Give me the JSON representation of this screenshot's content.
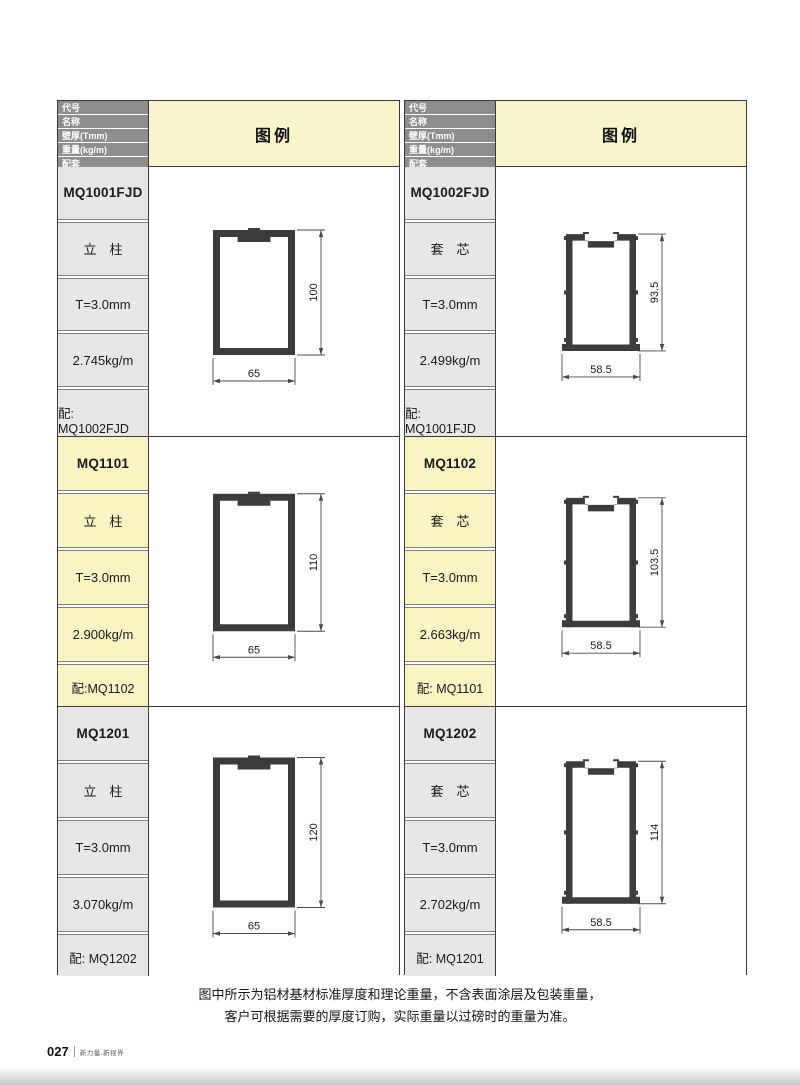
{
  "header_labels": {
    "code": "代号",
    "name": "名称",
    "thickness": "壁厚(Tmm)",
    "weight": "重量(kg/m)",
    "match": "配套",
    "legend": "图例"
  },
  "note": {
    "line1": "图中所示为铝材基材标准厚度和理论重量，不含表面涂层及包装重量，",
    "line2": "客户可根据需要的厚度订购，实际重量以过磅时的重量为准。"
  },
  "footer": {
    "page_number": "027",
    "slogan": "新力量.新视界"
  },
  "colors": {
    "header_bar": "#8d8d8d",
    "row_gray": "#e7e7e7",
    "row_highlight": "#f9f4c4",
    "legend_bg": "#f9f5cb",
    "profile_fill": "#3c3c3c",
    "dimension_line": "#4a4a4a"
  },
  "tables": [
    {
      "side": "left",
      "rows": [
        {
          "code": "MQ1001FJD",
          "name": "立　柱",
          "thickness": "T=3.0mm",
          "weight": "2.745kg/m",
          "match": "配: MQ1002FJD",
          "highlight": false,
          "diagram": {
            "shape": "column",
            "width_label": "65",
            "height_label": "100",
            "width_units": 65,
            "height_units": 100
          }
        },
        {
          "code": "MQ1101",
          "name": "立　柱",
          "thickness": "T=3.0mm",
          "weight": "2.900kg/m",
          "match": "配:MQ1102",
          "highlight": true,
          "diagram": {
            "shape": "column",
            "width_label": "65",
            "height_label": "110",
            "width_units": 65,
            "height_units": 110
          }
        },
        {
          "code": "MQ1201",
          "name": "立　柱",
          "thickness": "T=3.0mm",
          "weight": "3.070kg/m",
          "match": "配: MQ1202",
          "highlight": false,
          "diagram": {
            "shape": "column",
            "width_label": "65",
            "height_label": "120",
            "width_units": 65,
            "height_units": 120
          }
        }
      ]
    },
    {
      "side": "right",
      "rows": [
        {
          "code": "MQ1002FJD",
          "name": "套　芯",
          "thickness": "T=3.0mm",
          "weight": "2.499kg/m",
          "match": "配: MQ1001FJD",
          "highlight": false,
          "diagram": {
            "shape": "sleeve",
            "width_label": "58.5",
            "height_label": "93.5",
            "width_units": 58.5,
            "height_units": 93.5
          }
        },
        {
          "code": "MQ1102",
          "name": "套　芯",
          "thickness": "T=3.0mm",
          "weight": "2.663kg/m",
          "match": "配: MQ1101",
          "highlight": true,
          "diagram": {
            "shape": "sleeve",
            "width_label": "58.5",
            "height_label": "103.5",
            "width_units": 58.5,
            "height_units": 103.5
          }
        },
        {
          "code": "MQ1202",
          "name": "套　芯",
          "thickness": "T=3.0mm",
          "weight": "2.702kg/m",
          "match": "配: MQ1201",
          "highlight": false,
          "diagram": {
            "shape": "sleeve",
            "width_label": "58.5",
            "height_label": "114",
            "width_units": 58.5,
            "height_units": 114
          }
        }
      ]
    }
  ]
}
